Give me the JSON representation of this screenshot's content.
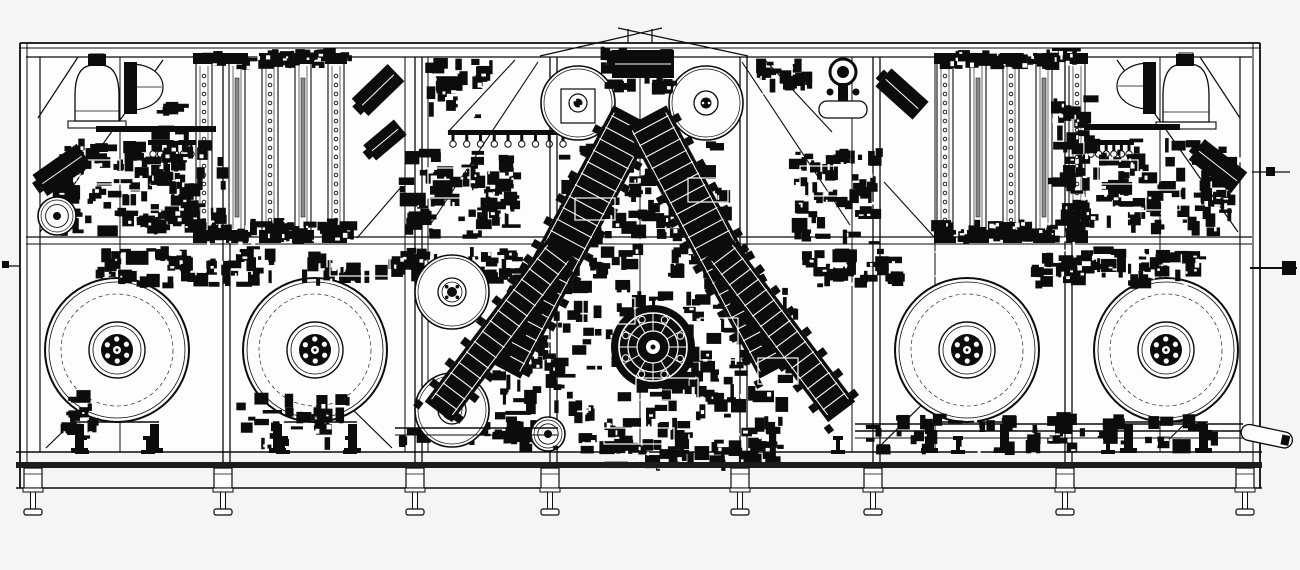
{
  "title": "CAD front elevation drawing of an automated assembly machine line",
  "canvas": {
    "width": 1300,
    "height": 570
  },
  "colors": {
    "background": "#f5f5f6",
    "paper": "#fdfdfd",
    "ink": "#0c0c0c",
    "band": "#1d1d1d",
    "gray": "#8a8a8a"
  },
  "layers": [
    {
      "name": "paper-body",
      "type": "rects",
      "items": [
        [
          20,
          43,
          1240,
          409,
          "paper",
          "none",
          0
        ]
      ]
    },
    {
      "name": "frame-rails",
      "type": "lines",
      "items": [
        [
          20,
          43,
          1260,
          43,
          1.8
        ],
        [
          20,
          48,
          1260,
          48,
          1
        ],
        [
          26,
          57,
          1252,
          57,
          1.2
        ],
        [
          26,
          237,
          1252,
          237,
          1.2
        ],
        [
          26,
          244,
          1252,
          244,
          1
        ],
        [
          16,
          452,
          1262,
          452,
          1.4
        ],
        [
          16,
          488,
          1262,
          488,
          1.4
        ],
        [
          20,
          43,
          20,
          488,
          1.8
        ],
        [
          27,
          43,
          27,
          488,
          1
        ],
        [
          40,
          57,
          40,
          452,
          1.2
        ],
        [
          1260,
          43,
          1260,
          488,
          1.8
        ],
        [
          1253,
          43,
          1253,
          488,
          1
        ],
        [
          1240,
          57,
          1240,
          452,
          1.2
        ]
      ]
    },
    {
      "name": "frame-posts",
      "type": "posts",
      "gap": 7,
      "y1": 57,
      "y2": 462,
      "doubles": [
        223,
        415,
        550,
        740,
        873,
        1065
      ],
      "singles": [
        120,
        405,
        428,
        640,
        852,
        935,
        1160
      ]
    },
    {
      "name": "frame-diagonals",
      "type": "lines",
      "items": [
        [
          40,
          232,
          163,
          60,
          1.2
        ],
        [
          38,
          118,
          78,
          57,
          1.2
        ],
        [
          1238,
          232,
          1117,
          60,
          1.2
        ],
        [
          1240,
          118,
          1200,
          57,
          1.2
        ],
        [
          540,
          56,
          662,
          28,
          1.2
        ],
        [
          618,
          28,
          748,
          56,
          1.2
        ],
        [
          628,
          29,
          628,
          43,
          1.2
        ],
        [
          652,
          29,
          652,
          43,
          1.2
        ],
        [
          430,
          225,
          538,
          62,
          1.1
        ],
        [
          850,
          225,
          742,
          62,
          1.1
        ],
        [
          765,
          60,
          832,
          132,
          1.1
        ],
        [
          884,
          182,
          935,
          238,
          1.1
        ],
        [
          515,
          60,
          448,
          132,
          1.1
        ],
        [
          402,
          186,
          357,
          238,
          1.1
        ],
        [
          46,
          448,
          140,
          356,
          1.2
        ],
        [
          298,
          356,
          392,
          448,
          1.2
        ],
        [
          878,
          448,
          957,
          370,
          1.2
        ],
        [
          1234,
          376,
          1160,
          448,
          1.2
        ]
      ]
    },
    {
      "name": "left-track-bank",
      "type": "tracks",
      "x0": 196,
      "dx": 33,
      "count": 5,
      "w": 16,
      "yTop": 62,
      "yBot": 233
    },
    {
      "name": "right-track-bank",
      "type": "tracks",
      "x0": 937,
      "dx": 33,
      "count": 5,
      "w": 16,
      "yTop": 62,
      "yBot": 233
    },
    {
      "name": "bowl-feeders",
      "type": "dome",
      "items": [
        [
          97,
          121,
          44,
          56
        ],
        [
          1186,
          122,
          46,
          58
        ]
      ]
    },
    {
      "name": "side-bowl-feeders",
      "type": "hdome",
      "items": [
        [
          130,
          87,
          44,
          46,
          1
        ],
        [
          1150,
          86,
          44,
          46,
          -1
        ]
      ]
    },
    {
      "name": "feeder-brackets",
      "type": "rects",
      "items": [
        [
          124,
          62,
          13,
          52,
          "ink",
          "none",
          0
        ],
        [
          1143,
          62,
          13,
          52,
          "ink",
          "none",
          0
        ],
        [
          88,
          54,
          18,
          12,
          "ink",
          "none",
          0
        ],
        [
          1176,
          54,
          18,
          12,
          "ink",
          "none",
          0
        ],
        [
          96,
          126,
          120,
          6,
          "ink",
          "none",
          0
        ],
        [
          1084,
          124,
          96,
          6,
          "ink",
          "none",
          0
        ]
      ]
    },
    {
      "name": "pickup-combs",
      "type": "comb",
      "items": [
        [
          148,
          140,
          48,
          6
        ],
        [
          448,
          130,
          120,
          9
        ],
        [
          1086,
          140,
          48,
          6
        ]
      ]
    },
    {
      "name": "payoff-reels",
      "type": "reel",
      "items": [
        [
          117,
          350
        ],
        [
          315,
          350
        ],
        [
          967,
          350
        ],
        [
          1166,
          350
        ]
      ]
    },
    {
      "name": "machinery-clusters-side",
      "type": "cluster",
      "items": [
        [
          60,
          138,
          170,
          100,
          95,
          1
        ],
        [
          150,
          92,
          46,
          140,
          40,
          2
        ],
        [
          196,
          48,
          160,
          22,
          32,
          3
        ],
        [
          192,
          218,
          170,
          26,
          40,
          4
        ],
        [
          94,
          246,
          190,
          44,
          60,
          5
        ],
        [
          300,
          250,
          130,
          36,
          34,
          6
        ],
        [
          398,
          148,
          125,
          92,
          70,
          7
        ],
        [
          404,
          246,
          120,
          38,
          32,
          8
        ],
        [
          788,
          148,
          95,
          100,
          60,
          13
        ],
        [
          790,
          248,
          115,
          40,
          34,
          14
        ],
        [
          1028,
          246,
          185,
          44,
          60,
          15
        ],
        [
          1062,
          138,
          172,
          100,
          95,
          16
        ],
        [
          1048,
          92,
          52,
          140,
          40,
          17
        ],
        [
          937,
          48,
          150,
          22,
          30,
          18
        ],
        [
          930,
          218,
          160,
          26,
          40,
          19
        ],
        [
          235,
          392,
          115,
          58,
          30,
          20
        ],
        [
          862,
          412,
          370,
          44,
          55,
          21
        ],
        [
          398,
          420,
          165,
          32,
          30,
          23
        ],
        [
          60,
          390,
          40,
          50,
          16,
          24
        ],
        [
          425,
          58,
          70,
          62,
          25,
          25
        ],
        [
          755,
          58,
          60,
          40,
          20,
          26
        ],
        [
          46,
          150,
          40,
          70,
          18,
          27
        ],
        [
          1212,
          150,
          28,
          70,
          14,
          28
        ]
      ]
    },
    {
      "name": "guide-rolls",
      "type": "roll",
      "items": [
        [
          578,
          103,
          37,
          "bracket"
        ],
        [
          706,
          103,
          37,
          "hub"
        ],
        [
          452,
          292,
          37,
          "rings"
        ],
        [
          452,
          410,
          37,
          "rings"
        ],
        [
          548,
          434,
          17,
          "small"
        ],
        [
          57,
          216,
          19,
          "small"
        ]
      ]
    },
    {
      "name": "machinery-clusters-center",
      "type": "cluster",
      "items": [
        [
          600,
          46,
          80,
          50,
          30,
          9
        ],
        [
          552,
          140,
          180,
          140,
          120,
          10
        ],
        [
          550,
          278,
          250,
          178,
          190,
          11
        ],
        [
          492,
          300,
          70,
          145,
          48,
          12
        ],
        [
          598,
          438,
          185,
          34,
          38,
          22
        ]
      ]
    },
    {
      "name": "feeder-arms",
      "type": "arm",
      "items": [
        [
          567,
          242,
          285,
          46,
          28
        ],
        [
          713,
          242,
          285,
          46,
          -28
        ],
        [
          500,
          330,
          205,
          34,
          37
        ],
        [
          780,
          330,
          205,
          34,
          -37
        ]
      ]
    },
    {
      "name": "index-turret",
      "type": "turret",
      "items": [
        [
          653,
          347
        ]
      ]
    },
    {
      "name": "housing-outlines",
      "type": "wrects",
      "items": [
        [
          583,
          298,
          52,
          26
        ],
        [
          636,
          378,
          62,
          22
        ],
        [
          700,
          318,
          38,
          42
        ],
        [
          604,
          428,
          70,
          16
        ],
        [
          758,
          358,
          40,
          26
        ],
        [
          575,
          198,
          40,
          22
        ],
        [
          688,
          178,
          40,
          24
        ],
        [
          80,
          160,
          40,
          24
        ],
        [
          130,
          190,
          34,
          20
        ],
        [
          1098,
          160,
          40,
          24
        ],
        [
          1146,
          190,
          34,
          20
        ],
        [
          428,
          168,
          42,
          30
        ],
        [
          800,
          166,
          42,
          30
        ],
        [
          910,
          252,
          60,
          24
        ],
        [
          330,
          252,
          60,
          24
        ]
      ]
    },
    {
      "name": "angled-units",
      "type": "ablock",
      "items": [
        [
          62,
          170,
          54,
          26,
          -35
        ],
        [
          378,
          90,
          50,
          24,
          -44
        ],
        [
          385,
          140,
          40,
          20,
          -40
        ],
        [
          902,
          94,
          50,
          24,
          42
        ],
        [
          1218,
          166,
          54,
          26,
          38
        ],
        [
          643,
          64,
          62,
          28,
          0
        ]
      ]
    },
    {
      "name": "sensor-mount",
      "type": "bomb",
      "items": [
        [
          843,
          72
        ]
      ]
    },
    {
      "name": "outfeed-conveyor",
      "type": "lines",
      "items": [
        [
          855,
          424,
          1243,
          424,
          1.4
        ],
        [
          855,
          431,
          1243,
          431,
          1.4
        ],
        [
          855,
          438,
          1243,
          438,
          1
        ],
        [
          395,
          428,
          558,
          428,
          1.4
        ],
        [
          395,
          435,
          558,
          435,
          1
        ]
      ]
    },
    {
      "name": "discharge-chute",
      "type": "capsule",
      "items": [
        [
          1243,
          423,
          52,
          16,
          12
        ]
      ]
    },
    {
      "name": "shaft-stubs-lines",
      "type": "lines",
      "items": [
        [
          1250,
          268,
          1297,
          268,
          2
        ],
        [
          1252,
          172,
          1290,
          172,
          1.2
        ],
        [
          3,
          266,
          20,
          266,
          1.2
        ]
      ]
    },
    {
      "name": "shaft-stubs-blocks",
      "type": "rects",
      "items": [
        [
          1282,
          261,
          14,
          14,
          "ink",
          "none",
          0
        ],
        [
          1266,
          167,
          9,
          9,
          "ink",
          "none",
          0
        ],
        [
          2,
          261,
          7,
          7,
          "ink",
          "none",
          0
        ]
      ]
    },
    {
      "name": "base-band",
      "type": "rects",
      "items": [
        [
          16,
          462,
          1246,
          6,
          "band",
          "none",
          0
        ]
      ]
    },
    {
      "name": "leveling-jacks",
      "type": "jacks",
      "y": 440,
      "xs": [
        82,
        148,
        283,
        350,
        682,
        838,
        958,
        1108
      ]
    },
    {
      "name": "machine-legs",
      "type": "legs",
      "xs": [
        33,
        223,
        415,
        550,
        740,
        873,
        1065,
        1245
      ]
    }
  ]
}
